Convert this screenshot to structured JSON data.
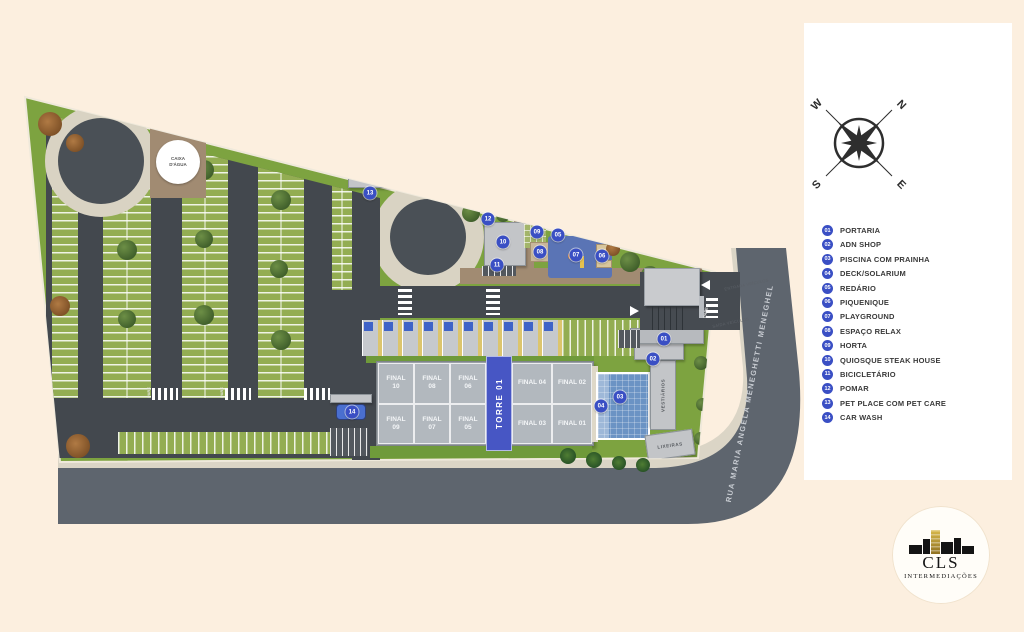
{
  "colors": {
    "background_cream": "#fcefdf",
    "marker_blue": "#3a4fc4",
    "site_green": "#7da340",
    "asphalt_dark": "#43484e",
    "street_gray": "#5e656e",
    "pool_blue": "#6b93c4",
    "torre_blue": "#4756c4",
    "logo_gold": "#b8962e"
  },
  "site_plan": {
    "caixa_dagua": "CAIXA D'ÁGUA",
    "street_name": "RUA MARIA ANGELA MENEGHETTI MENEGHEL",
    "pare": "PARE",
    "entrance_labels": {
      "entrada": "ENTRADA VEÍCULOS",
      "saida": "SAÍDA VEÍCULOS"
    },
    "tower": {
      "name": "TORRE 01",
      "units": [
        "FINAL 10",
        "FINAL 09",
        "FINAL 08",
        "FINAL 07",
        "FINAL 06",
        "FINAL 05",
        "FINAL 04",
        "FINAL 03",
        "FINAL 02",
        "FINAL 01"
      ]
    },
    "buildings": {
      "vestiarios": "VESTIÁRIOS",
      "lixeiras": "LIXEIRAS"
    },
    "markers": [
      {
        "num": "01",
        "x": 664,
        "y": 339
      },
      {
        "num": "02",
        "x": 653,
        "y": 359
      },
      {
        "num": "03",
        "x": 620,
        "y": 397
      },
      {
        "num": "04",
        "x": 601,
        "y": 406
      },
      {
        "num": "05",
        "x": 558,
        "y": 235
      },
      {
        "num": "06",
        "x": 602,
        "y": 256
      },
      {
        "num": "07",
        "x": 576,
        "y": 255
      },
      {
        "num": "08",
        "x": 540,
        "y": 252
      },
      {
        "num": "09",
        "x": 537,
        "y": 232
      },
      {
        "num": "10",
        "x": 503,
        "y": 242
      },
      {
        "num": "11",
        "x": 497,
        "y": 265
      },
      {
        "num": "12",
        "x": 488,
        "y": 219
      },
      {
        "num": "13",
        "x": 370,
        "y": 193
      },
      {
        "num": "14",
        "x": 352,
        "y": 412
      }
    ]
  },
  "legend": {
    "items": [
      {
        "num": "01",
        "label": "PORTARIA"
      },
      {
        "num": "02",
        "label": "ADN SHOP"
      },
      {
        "num": "03",
        "label": "PISCINA COM PRAINHA"
      },
      {
        "num": "04",
        "label": "DECK/SOLARIUM"
      },
      {
        "num": "05",
        "label": "REDÁRIO"
      },
      {
        "num": "06",
        "label": "PIQUENIQUE"
      },
      {
        "num": "07",
        "label": "PLAYGROUND"
      },
      {
        "num": "08",
        "label": "ESPAÇO RELAX"
      },
      {
        "num": "09",
        "label": "HORTA"
      },
      {
        "num": "10",
        "label": "QUIOSQUE STEAK HOUSE"
      },
      {
        "num": "11",
        "label": "BICICLETÁRIO"
      },
      {
        "num": "12",
        "label": "POMAR"
      },
      {
        "num": "13",
        "label": "PET PLACE COM PET CARE"
      },
      {
        "num": "14",
        "label": "CAR WASH"
      }
    ]
  },
  "compass": {
    "n": "N",
    "e": "E",
    "s": "S",
    "w": "W"
  },
  "logo": {
    "name": "CLS",
    "subtitle": "INTERMEDIAÇÕES"
  }
}
